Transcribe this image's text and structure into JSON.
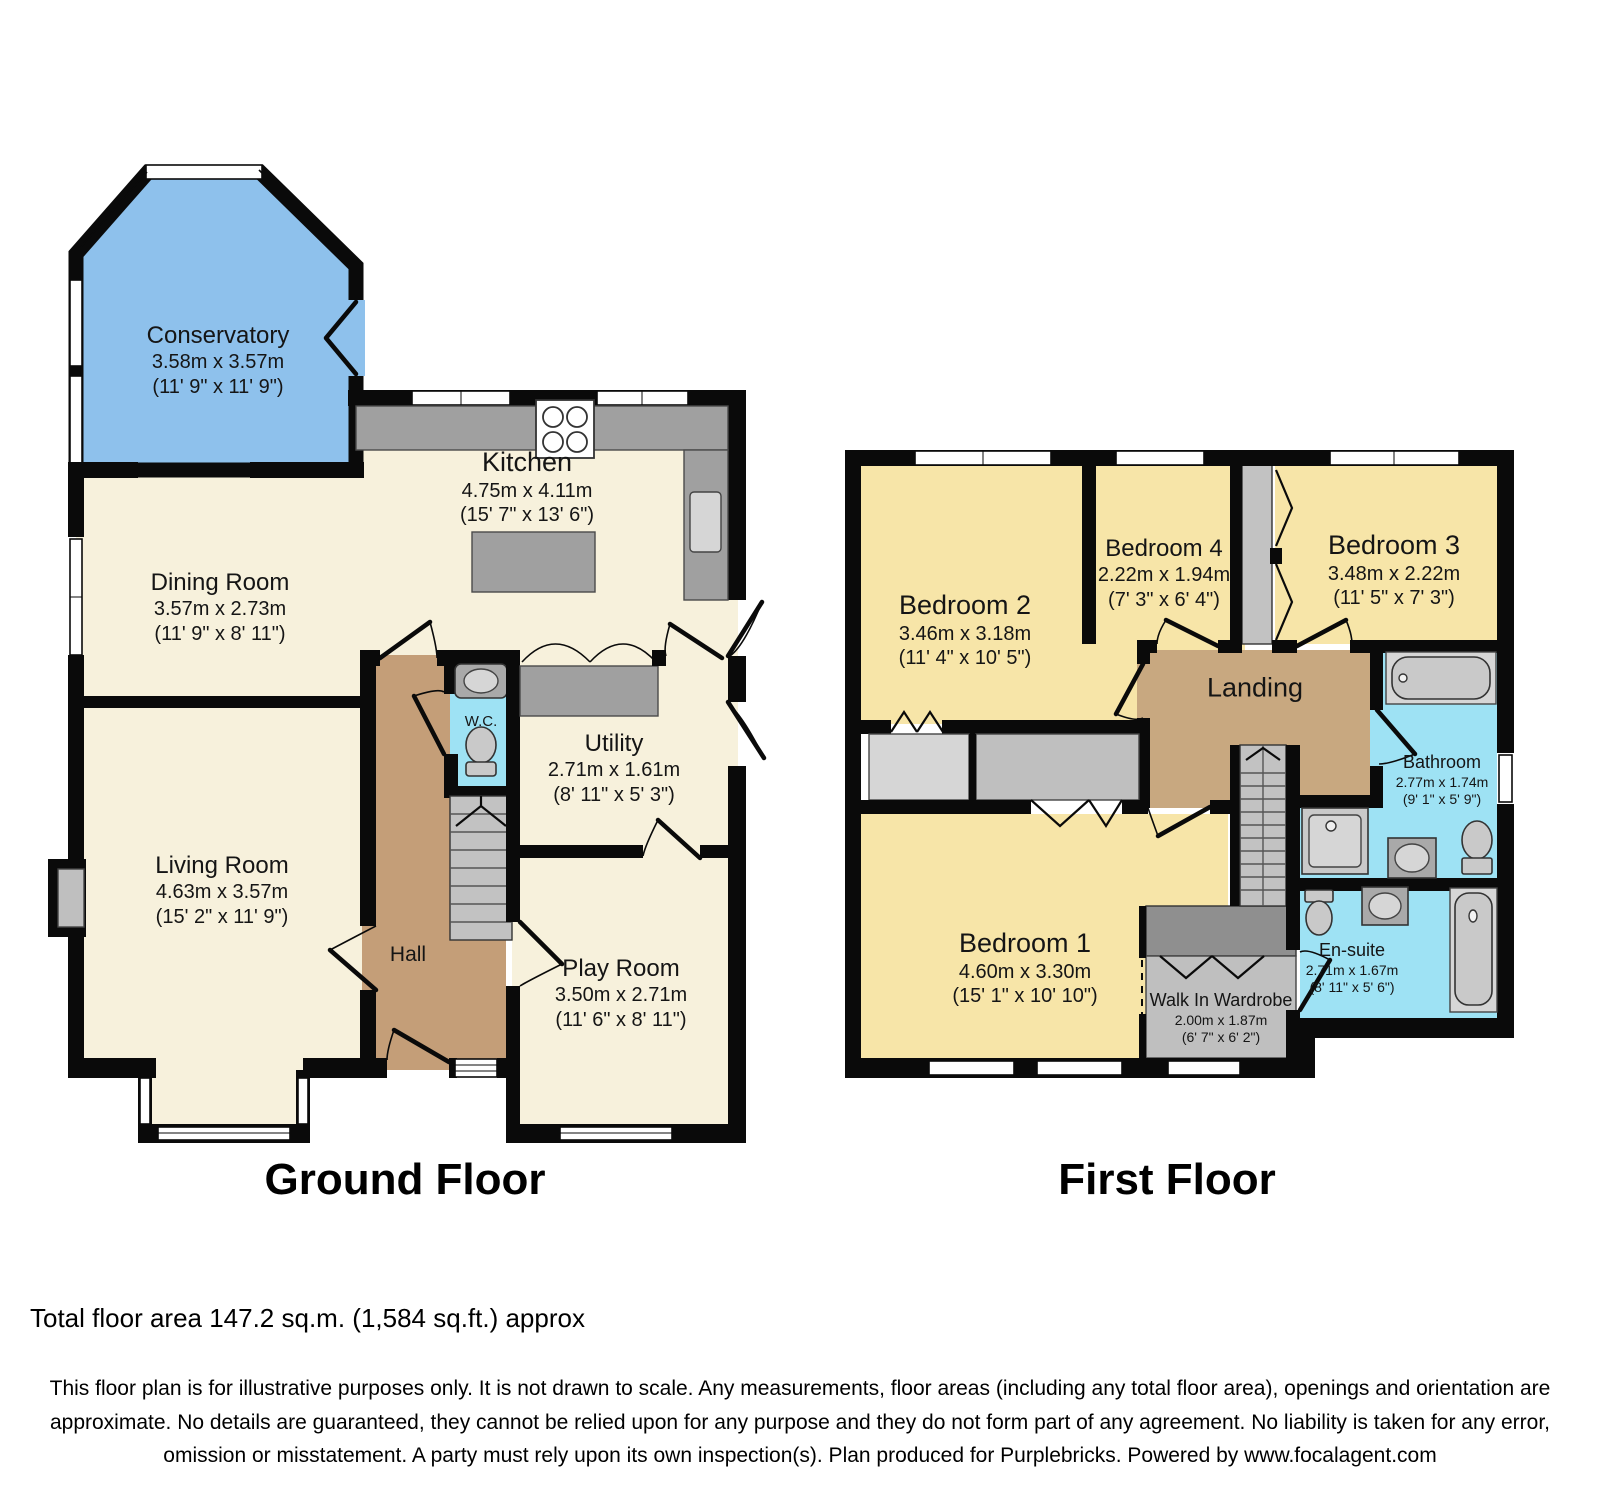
{
  "ground_floor": {
    "title": "Ground Floor",
    "rooms": [
      {
        "name": "Conservatory",
        "dims_m": "3.58m x 3.57m",
        "dims_ft": "(11' 9\" x 11' 9\")"
      },
      {
        "name": "Dining Room",
        "dims_m": "3.57m x 2.73m",
        "dims_ft": "(11' 9\" x 8' 11\")"
      },
      {
        "name": "Kitchen",
        "dims_m": "4.75m x 4.11m",
        "dims_ft": "(15' 7\" x 13' 6\")"
      },
      {
        "name": "Living Room",
        "dims_m": "4.63m x 3.57m",
        "dims_ft": "(15' 2\" x 11' 9\")"
      },
      {
        "name": "W.C."
      },
      {
        "name": "Utility",
        "dims_m": "2.71m x 1.61m",
        "dims_ft": "(8' 11\" x 5' 3\")"
      },
      {
        "name": "Hall"
      },
      {
        "name": "Play Room",
        "dims_m": "3.50m x 2.71m",
        "dims_ft": "(11' 6\" x 8' 11\")"
      }
    ]
  },
  "first_floor": {
    "title": "First Floor",
    "rooms": [
      {
        "name": "Bedroom 2",
        "dims_m": "3.46m x 3.18m",
        "dims_ft": "(11' 4\" x 10' 5\")"
      },
      {
        "name": "Bedroom 4",
        "dims_m": "2.22m x 1.94m",
        "dims_ft": "(7' 3\" x 6' 4\")"
      },
      {
        "name": "Bedroom 3",
        "dims_m": "3.48m x 2.22m",
        "dims_ft": "(11' 5\" x 7' 3\")"
      },
      {
        "name": "Landing"
      },
      {
        "name": "Bathroom",
        "dims_m": "2.77m x 1.74m",
        "dims_ft": "(9' 1\" x 5' 9\")"
      },
      {
        "name": "Bedroom 1",
        "dims_m": "4.60m x 3.30m",
        "dims_ft": "(15' 1\" x 10' 10\")"
      },
      {
        "name": "Walk In Wardrobe",
        "dims_m": "2.00m x 1.87m",
        "dims_ft": "(6' 7\" x 6' 2\")"
      },
      {
        "name": "En-suite",
        "dims_m": "2.71m x 1.67m",
        "dims_ft": "(8' 11\" x 5' 6\")"
      }
    ]
  },
  "footer": {
    "total_area": "Total floor area 147.2 sq.m. (1,584 sq.ft.) approx",
    "disclaimer": "This floor plan is for illustrative purposes only. It is not drawn to scale. Any measurements, floor areas (including any total floor area), openings and orientation are approximate. No details are guaranteed, they cannot be relied upon for any purpose and they do not form part of any agreement. No liability is taken for any error, omission or misstatement. A party must rely upon its own inspection(s). Plan produced for Purplebricks. Powered by www.focalagent.com"
  },
  "colors": {
    "wall": "#0a0a0a",
    "room_cream": "#F7F1DC",
    "room_yellow": "#F7E5A8",
    "conservatory_blue": "#8EC1EC",
    "wet_room_cyan": "#9EE2F4",
    "hall_tan": "#C49E78",
    "landing_tan": "#C8A880",
    "counter_gray": "#A0A0A0",
    "stairs_gray": "#C2C2C2",
    "dark_gray": "#8F8F8F",
    "fixture_gray": "#C9C9C9"
  }
}
